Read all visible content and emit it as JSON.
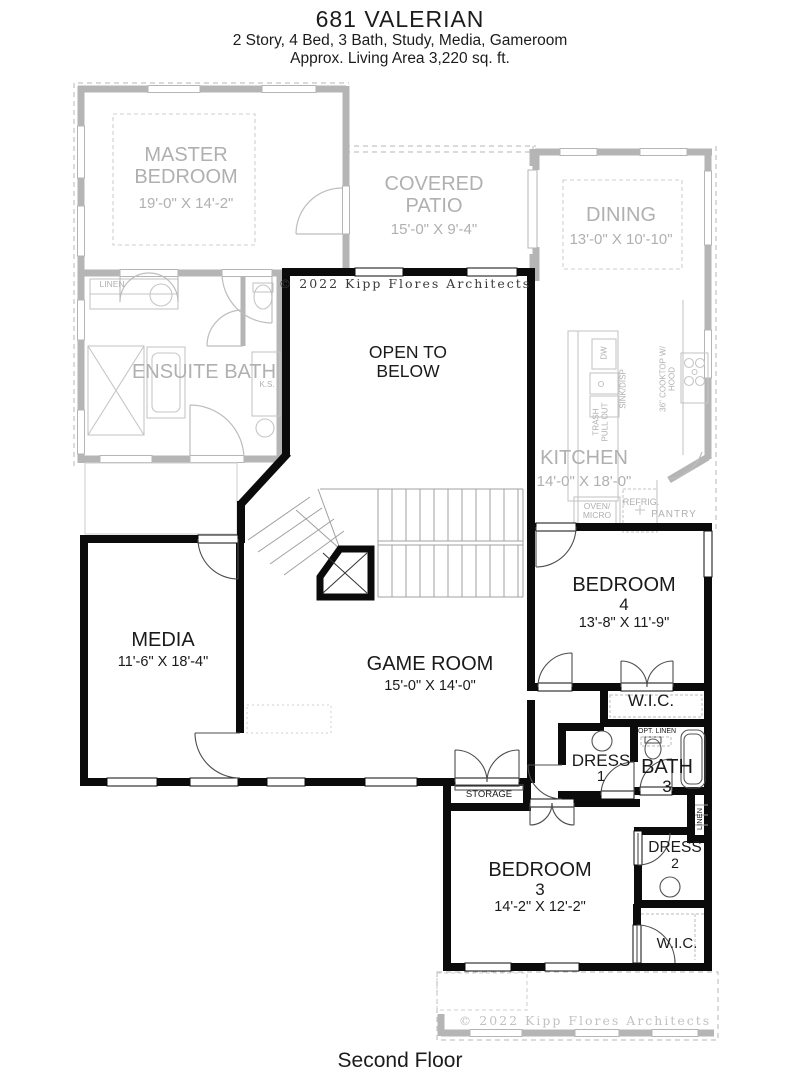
{
  "header": {
    "title": "681 VALERIAN",
    "subtitle": "2 Story, 4 Bed, 3 Bath, Study, Media, Gameroom",
    "area": "Approx. Living Area 3,220 sq. ft."
  },
  "footer": {
    "label": "Second Floor"
  },
  "copyright": {
    "top": "© 2022 Kipp Flores Architects",
    "bottom": "© 2022 Kipp Flores Architects"
  },
  "first_floor": {
    "master_bedroom": {
      "name": "MASTER BEDROOM",
      "dims": "19'-0\" X 14'-2\""
    },
    "covered_patio": {
      "name": "COVERED PATIO",
      "dims": "15'-0\" X 9'-4\""
    },
    "dining": {
      "name": "DINING",
      "dims": "13'-0\" X 10'-10\""
    },
    "ensuite_bath": {
      "name": "ENSUITE BATH"
    },
    "kitchen": {
      "name": "KITCHEN",
      "dims": "14'-0\" X 18'-0\""
    },
    "labels": {
      "linen": "LINEN",
      "ks": "K.S.",
      "dw": "DW",
      "sink": "SINK/DISP",
      "trash": "TRASH PULL OUT",
      "cooktop": "36\" COOKTOP W/ HOOD",
      "oven": "OVEN/ MICRO",
      "refrig": "REFRIG.",
      "pantry": "PANTRY"
    }
  },
  "second_floor": {
    "open_to_below": {
      "name": "OPEN TO BELOW"
    },
    "media": {
      "name": "MEDIA",
      "dims": "11'-6\" X 18'-4\""
    },
    "game_room": {
      "name": "GAME ROOM",
      "dims": "15'-0\" X 14'-0\""
    },
    "bedroom_4": {
      "name": "BEDROOM",
      "number": "4",
      "dims": "13'-8\" X 11'-9\""
    },
    "bedroom_3": {
      "name": "BEDROOM",
      "number": "3",
      "dims": "14'-2\" X 12'-2\""
    },
    "wic_bedroom4": {
      "name": "W.I.C."
    },
    "wic_bedroom3": {
      "name": "W.I.C."
    },
    "dress_1": {
      "name": "DRESS",
      "number": "1"
    },
    "dress_2": {
      "name": "DRESS",
      "number": "2"
    },
    "bath_3": {
      "name": "BATH",
      "number": "3"
    },
    "storage": {
      "name": "STORAGE"
    },
    "labels": {
      "opt_linen": "OPT. LINEN",
      "linen": "LINEN"
    }
  },
  "colors": {
    "wall": "#0b0b0b",
    "ghost_wall": "#b5b5b5",
    "ghost_text": "#b0b0b0",
    "text": "#1a1a1a",
    "stair": "#a0a0a0"
  }
}
